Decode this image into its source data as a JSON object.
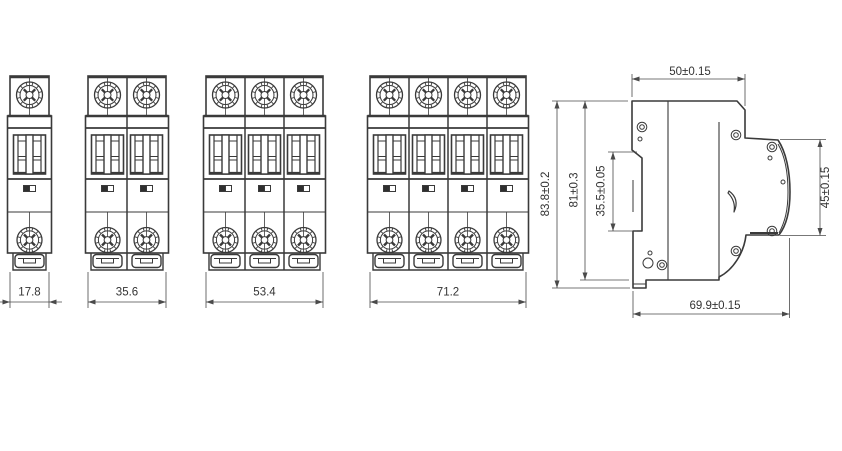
{
  "drawing": {
    "type": "engineering-dimension-drawing",
    "subject": "miniature-circuit-breaker",
    "front_views": [
      {
        "name": "1-pole",
        "poles": 1,
        "width_label": "17.8"
      },
      {
        "name": "2-pole",
        "poles": 2,
        "width_label": "35.6"
      },
      {
        "name": "3-pole",
        "poles": 3,
        "width_label": "53.4"
      },
      {
        "name": "4-pole",
        "poles": 4,
        "width_label": "71.2"
      }
    ],
    "side_view": {
      "name": "side-view",
      "width_top_label": "50±0.15",
      "height_total_label": "83.8±0.2",
      "height_body_label": "81±0.3",
      "din_slot_label": "35.5±0.05",
      "front_height_label": "45±0.15",
      "depth_label": "69.9±0.15"
    },
    "colors": {
      "line": "#3a3a3a",
      "dim_line": "#4a4a4a",
      "text": "#333333",
      "background": "#ffffff",
      "indicator_fill": "#2f2f2f"
    }
  }
}
